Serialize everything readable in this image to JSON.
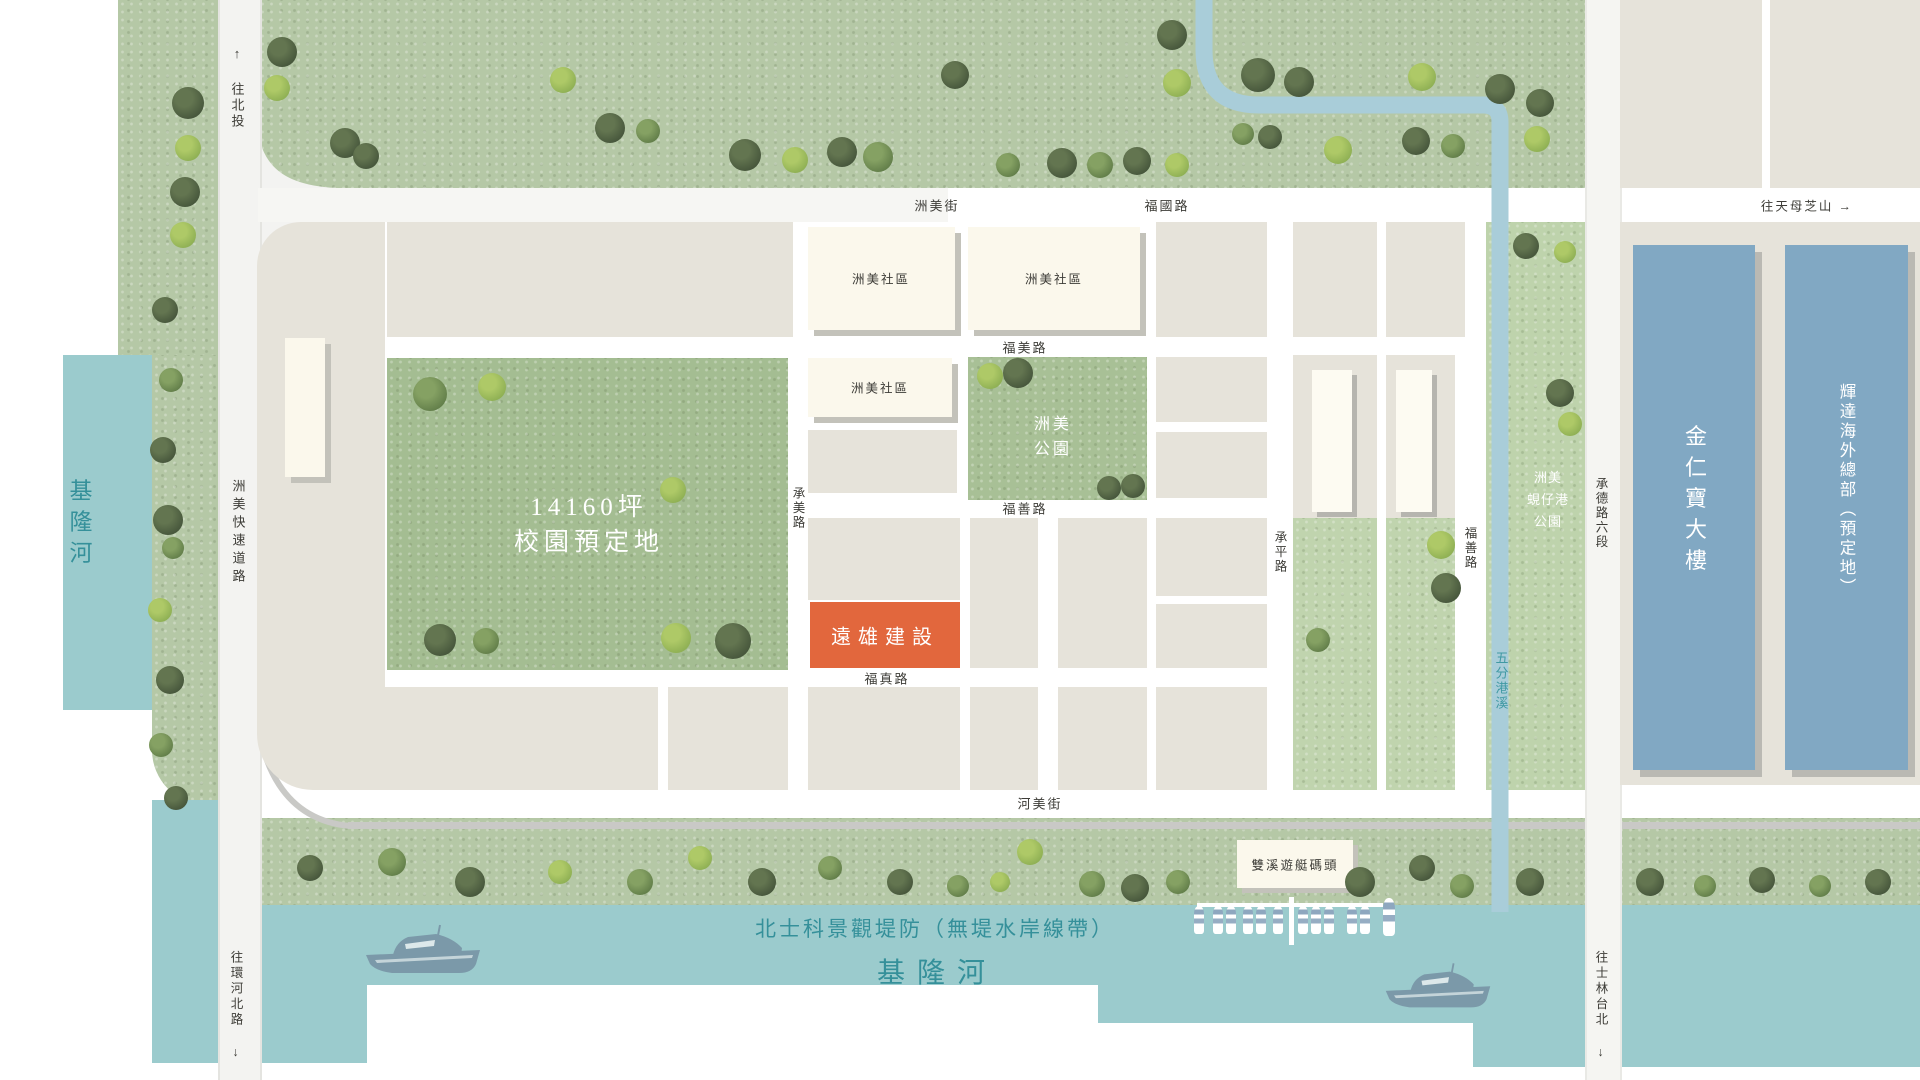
{
  "map": {
    "rivers": {
      "keelung": "基隆河",
      "keelung_main": "基隆河",
      "levee": "北士科景觀堤防（無堤水岸線帶）",
      "stream": "五分港溪"
    },
    "roads": {
      "expressway": "洲美快速道路",
      "zhoumei_st": "洲美街",
      "fuguo": "福國路",
      "fumei": "福美路",
      "fushan": "福善路",
      "fushan_v": "福善路",
      "fuzhen": "福真路",
      "hemei": "河美街",
      "chengmei": "承美路",
      "chengping": "承平路",
      "chengde": "承德路六段"
    },
    "directions": {
      "north": "↑ 往北投",
      "tianmu": "往天母芝山 →",
      "huanhe": "往環河北路 ↓",
      "shilin": "往士林台北 ↓"
    },
    "sites": {
      "campus_line1": "14160坪",
      "campus_line2": "校園預定地",
      "community": "洲美社區",
      "park_line1": "洲美",
      "park_line2": "公園",
      "farglory": "遠雄建設",
      "xianzai_line1": "洲美",
      "xianzai_line2": "蜆仔港",
      "xianzai_line3": "公園",
      "kinpo": "金仁寶大樓",
      "nvidia": "輝達海外總部（預定地）",
      "marina": "雙溪遊艇碼頭"
    },
    "colors": {
      "water": "#9bcbcd",
      "stream": "#a9cdd9",
      "grass": "#b5c8a6",
      "campus_green": "#a4bd92",
      "park_green": "#a8c096",
      "light_green": "#c0d4ae",
      "block_beige": "#e6e3da",
      "building_cream": "#fbf8ec",
      "building_blue": "#81a8c3",
      "accent_orange": "#e2673d",
      "teal_text": "#35909a",
      "road_grey": "#f3f3f1",
      "levee_line": "#c9c9c6",
      "label_dark": "#3d3c37",
      "boat": "#7b99a9"
    },
    "trees": [
      [
        282,
        52,
        30,
        "d"
      ],
      [
        277,
        88,
        26,
        "l"
      ],
      [
        345,
        143,
        30,
        "d"
      ],
      [
        366,
        156,
        26,
        "d"
      ],
      [
        563,
        80,
        26,
        "l"
      ],
      [
        610,
        128,
        30,
        "d"
      ],
      [
        648,
        131,
        24,
        "m"
      ],
      [
        745,
        155,
        32,
        "d"
      ],
      [
        795,
        160,
        26,
        "l"
      ],
      [
        842,
        152,
        30,
        "d"
      ],
      [
        878,
        157,
        30,
        "m"
      ],
      [
        955,
        75,
        28,
        "d"
      ],
      [
        1008,
        165,
        24,
        "m"
      ],
      [
        1062,
        163,
        30,
        "d"
      ],
      [
        1100,
        165,
        26,
        "m"
      ],
      [
        1137,
        161,
        28,
        "d"
      ],
      [
        1177,
        165,
        24,
        "l"
      ],
      [
        1172,
        35,
        30,
        "d"
      ],
      [
        1177,
        83,
        28,
        "l"
      ],
      [
        1258,
        75,
        34,
        "d"
      ],
      [
        1299,
        82,
        30,
        "d"
      ],
      [
        1243,
        134,
        22,
        "m"
      ],
      [
        1270,
        137,
        24,
        "d"
      ],
      [
        1338,
        150,
        28,
        "l"
      ],
      [
        1422,
        77,
        28,
        "l"
      ],
      [
        1500,
        89,
        30,
        "d"
      ],
      [
        1540,
        103,
        28,
        "d"
      ],
      [
        1416,
        141,
        28,
        "d"
      ],
      [
        1453,
        146,
        24,
        "m"
      ],
      [
        1537,
        139,
        26,
        "l"
      ],
      [
        1526,
        246,
        26,
        "d"
      ],
      [
        1565,
        252,
        22,
        "l"
      ],
      [
        188,
        103,
        32,
        "d"
      ],
      [
        188,
        148,
        26,
        "l"
      ],
      [
        185,
        192,
        30,
        "d"
      ],
      [
        183,
        235,
        26,
        "l"
      ],
      [
        165,
        310,
        26,
        "d"
      ],
      [
        171,
        380,
        24,
        "m"
      ],
      [
        163,
        450,
        26,
        "d"
      ],
      [
        168,
        520,
        30,
        "d"
      ],
      [
        173,
        548,
        22,
        "m"
      ],
      [
        160,
        610,
        24,
        "l"
      ],
      [
        170,
        680,
        28,
        "d"
      ],
      [
        161,
        745,
        24,
        "m"
      ],
      [
        176,
        798,
        24,
        "d"
      ],
      [
        430,
        394,
        34,
        "m"
      ],
      [
        492,
        387,
        28,
        "l"
      ],
      [
        673,
        490,
        26,
        "l"
      ],
      [
        440,
        640,
        32,
        "d"
      ],
      [
        486,
        641,
        26,
        "m"
      ],
      [
        676,
        638,
        30,
        "l"
      ],
      [
        733,
        641,
        36,
        "d"
      ],
      [
        990,
        376,
        26,
        "l"
      ],
      [
        1018,
        373,
        30,
        "d"
      ],
      [
        1109,
        488,
        24,
        "d"
      ],
      [
        1133,
        486,
        24,
        "d"
      ],
      [
        1441,
        545,
        28,
        "l"
      ],
      [
        1446,
        588,
        30,
        "d"
      ],
      [
        1318,
        640,
        24,
        "m"
      ],
      [
        1560,
        393,
        28,
        "d"
      ],
      [
        1570,
        424,
        24,
        "l"
      ],
      [
        310,
        868,
        26,
        "d"
      ],
      [
        392,
        862,
        28,
        "m"
      ],
      [
        470,
        882,
        30,
        "d"
      ],
      [
        560,
        872,
        24,
        "l"
      ],
      [
        640,
        882,
        26,
        "m"
      ],
      [
        700,
        858,
        24,
        "l"
      ],
      [
        762,
        882,
        28,
        "d"
      ],
      [
        830,
        868,
        24,
        "m"
      ],
      [
        900,
        882,
        26,
        "d"
      ],
      [
        958,
        886,
        22,
        "m"
      ],
      [
        1000,
        882,
        20,
        "l"
      ],
      [
        1030,
        852,
        26,
        "l"
      ],
      [
        1092,
        884,
        26,
        "m"
      ],
      [
        1135,
        888,
        28,
        "d"
      ],
      [
        1178,
        882,
        24,
        "m"
      ],
      [
        1360,
        882,
        30,
        "d"
      ],
      [
        1422,
        868,
        26,
        "d"
      ],
      [
        1462,
        886,
        24,
        "m"
      ],
      [
        1530,
        882,
        28,
        "d"
      ],
      [
        1650,
        882,
        28,
        "d"
      ],
      [
        1705,
        886,
        22,
        "m"
      ],
      [
        1762,
        880,
        26,
        "d"
      ],
      [
        1820,
        886,
        22,
        "m"
      ],
      [
        1878,
        882,
        26,
        "d"
      ]
    ],
    "marina_boats": [
      [
        1199,
        906,
        10,
        28
      ],
      [
        1218,
        906,
        10,
        28
      ],
      [
        1231,
        906,
        10,
        28
      ],
      [
        1248,
        906,
        10,
        28
      ],
      [
        1261,
        906,
        10,
        28
      ],
      [
        1278,
        906,
        10,
        28
      ],
      [
        1303,
        906,
        10,
        28
      ],
      [
        1316,
        906,
        10,
        28
      ],
      [
        1329,
        906,
        10,
        28
      ],
      [
        1352,
        906,
        10,
        28
      ],
      [
        1365,
        906,
        10,
        28
      ],
      [
        1389,
        898,
        12,
        38
      ]
    ]
  }
}
